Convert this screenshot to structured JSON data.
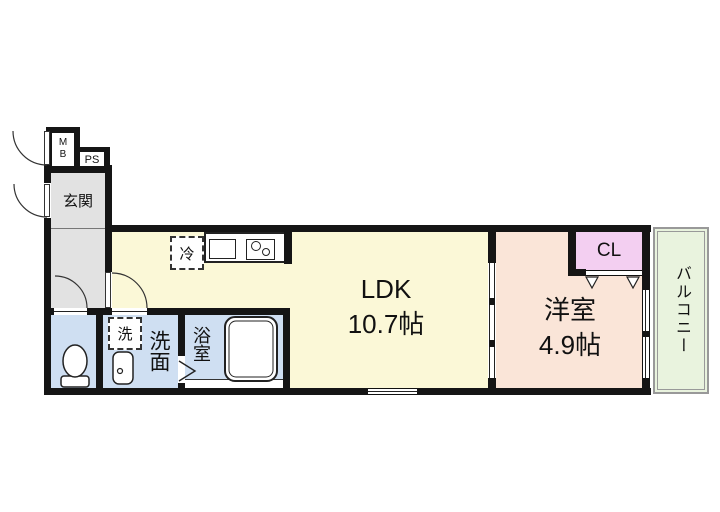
{
  "rooms": {
    "entrance": {
      "label": "玄関"
    },
    "meter_box": {
      "label": "MB"
    },
    "pipe_space": {
      "label": "PS"
    },
    "ldk": {
      "label": "LDK",
      "size": "10.7帖"
    },
    "western_room": {
      "label": "洋室",
      "size": "4.9帖"
    },
    "closet": {
      "label": "CL"
    },
    "balcony": {
      "label": "バルコニー"
    },
    "washroom": {
      "label": "洗面"
    },
    "bathroom": {
      "label": "浴室"
    }
  },
  "fixtures": {
    "refrigerator": {
      "label": "冷"
    },
    "washing_machine": {
      "label": "洗"
    }
  },
  "colors": {
    "wall": "#151515",
    "ldk_fill": "#fbf8d7",
    "western_fill": "#fae5d8",
    "closet_fill": "#f3cff1",
    "balcony_fill": "#e9f3de",
    "wet_area_fill": "#cfdff2",
    "entrance_fill": "#e2e2e2",
    "balcony_border": "#999999"
  }
}
